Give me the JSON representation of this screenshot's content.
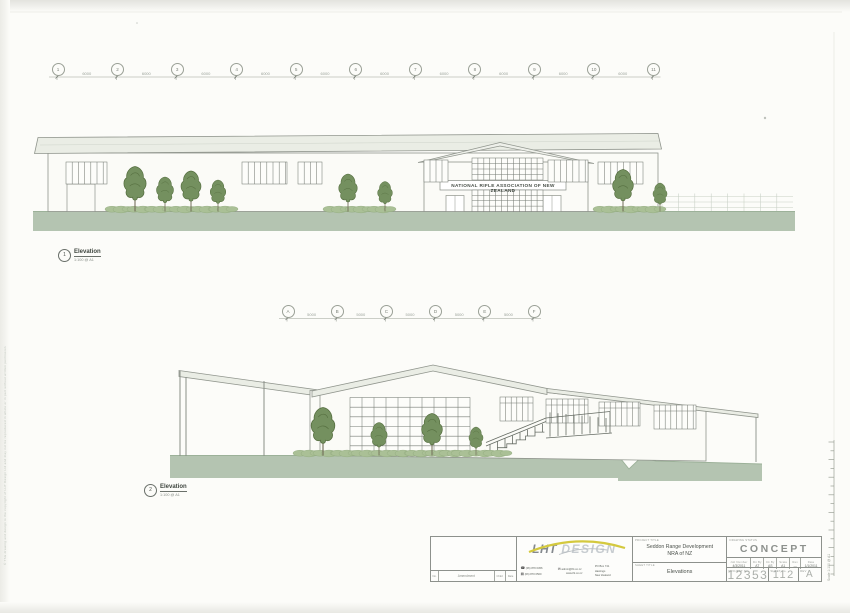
{
  "page": {
    "sign_text": "NATIONAL RIFLE ASSOCIATION OF NEW ZEALAND",
    "side_note": "© This drawing and design is the copyright of LHT Design Ltd and may not be reproduced in whole or in part without written permission",
    "scale_strip": "Scale 1:100 @ A1"
  },
  "grids": {
    "top": {
      "bubbles": [
        "1",
        "2",
        "3",
        "4",
        "5",
        "6",
        "7",
        "8",
        "9",
        "10",
        "11"
      ],
      "dims": [
        "6000",
        "6000",
        "6000",
        "6000",
        "6000",
        "6000",
        "6000",
        "6000",
        "6000",
        "6000"
      ]
    },
    "mid": {
      "bubbles": [
        "A",
        "B",
        "C",
        "D",
        "E",
        "F"
      ],
      "dims": [
        "5000",
        "5000",
        "5000",
        "5000",
        "5000"
      ]
    }
  },
  "elevations": [
    {
      "number": "1",
      "title": "Elevation",
      "scale": "1:100 @ A1"
    },
    {
      "number": "2",
      "title": "Elevation",
      "scale": "1:100 @ A1"
    }
  ],
  "title_block": {
    "amendment": {
      "no": "No.",
      "label": "Amendment",
      "chkd": "Chkd",
      "date": "Date"
    },
    "logo": {
      "bold": "LHT",
      "light": "DESIGN",
      "phone": "(06) 870 0456",
      "fax": "(06) 870 0500",
      "email": "admin@lht.co.nz",
      "web": "www.lht.co.nz",
      "address": [
        "PO Box 741",
        "Hastings",
        "New Zealand"
      ]
    },
    "project": {
      "caption": "PROJECT TITLE",
      "line1": "Seddon Range Development",
      "line2": "NRA of NZ"
    },
    "sheet": {
      "caption": "SHEET TITLE",
      "value": "Elevations"
    },
    "status": {
      "caption": "DRAWING STATUS",
      "value": "CONCEPT"
    },
    "fields": [
      {
        "label": "Job Number",
        "value": "4/3/2011"
      },
      {
        "label": "Dn By",
        "value": "AT"
      },
      {
        "label": "Ck By",
        "value": "AS"
      },
      {
        "label": "Scale",
        "value": "A1"
      },
      {
        "label": "Rev",
        "value": "—"
      },
      {
        "label": "Date",
        "value": "1/1/2011"
      }
    ],
    "numbers": {
      "project_caption": "PROJECT No.",
      "project": "12353",
      "sheet_caption": "SHEET No.",
      "sheet": "112",
      "rev_caption": "REV",
      "rev": "A"
    }
  }
}
